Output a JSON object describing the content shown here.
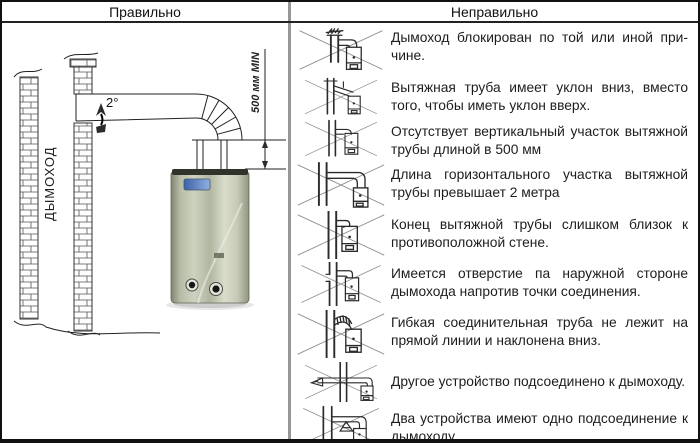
{
  "header": {
    "left": "Правильно",
    "right": "Неправильно"
  },
  "correct": {
    "chimney_label": "ДЫМОХОД",
    "angle_label": "2°",
    "dimension_label": "500 мм MIN"
  },
  "wrong": {
    "items": [
      {
        "icon": "blocked-chimney-icon",
        "text": "Дымоход блокирован по той или иной при­чине."
      },
      {
        "icon": "downward-slope-pipe-icon",
        "text": "Вытяжная труба имеет уклон вниз, вместо того, чтобы иметь уклон вверх."
      },
      {
        "icon": "missing-vertical-section-icon",
        "text": "Отсутствует вертикальный участок вытяжной трубы длиной в 500 мм"
      },
      {
        "icon": "long-horizontal-section-icon",
        "text": "Длина горизонтального участка вытяжной трубы превышает 2 метра"
      },
      {
        "icon": "pipe-close-to-wall-icon",
        "text": "Конец вытяжной трубы слишком близок к противоположной стене."
      },
      {
        "icon": "hole-in-chimney-icon",
        "text": "Имеется отверстие па наружной стороне дымохода напротив точки соединения."
      },
      {
        "icon": "sagging-flexible-pipe-icon",
        "text": "Гибкая соединительная труба не лежит на прямой линии и наклонена вниз."
      },
      {
        "icon": "extra-device-connected-icon",
        "text": "Другое устройство подсоединено к дымоходу."
      },
      {
        "icon": "two-devices-one-connection-icon",
        "text": "Два устройства имеют одно подсоедине­ние к дымоходу"
      }
    ]
  },
  "colors": {
    "border": "#111111",
    "divider_gray": "#979797",
    "line_art": "#2b2b2b",
    "cross_gray": "#909090",
    "heater_metal": "#b9bfaa",
    "heater_display_blue": "#4a6fb5"
  }
}
